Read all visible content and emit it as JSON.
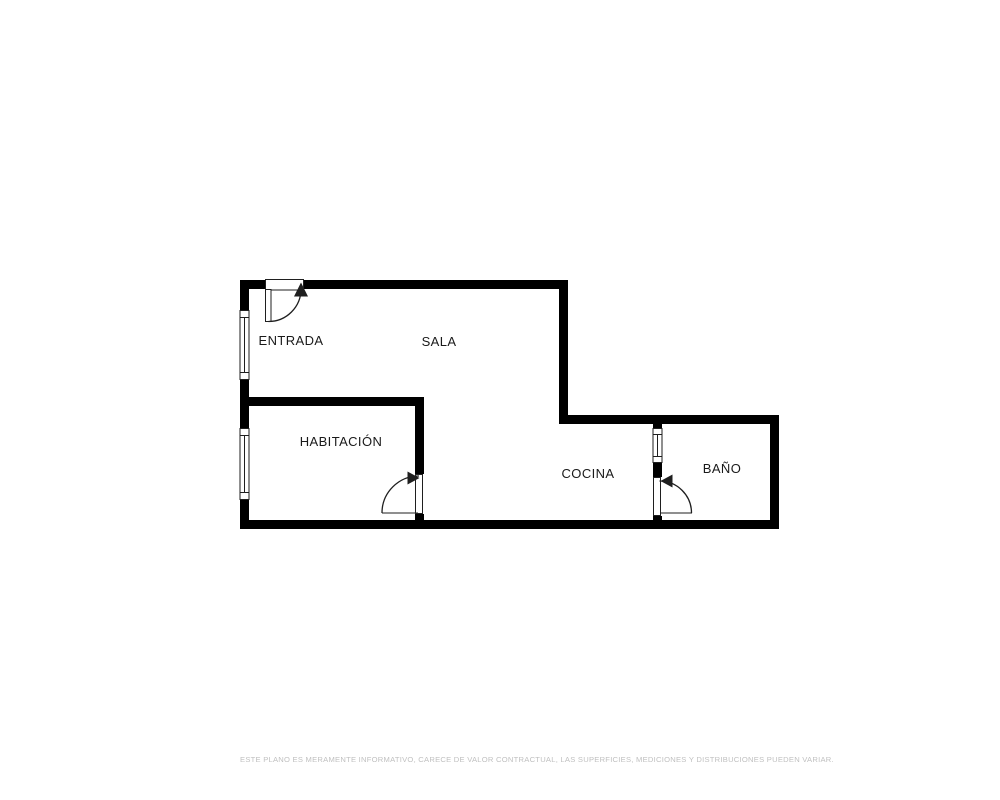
{
  "plan": {
    "colors": {
      "background": "#ffffff",
      "wall": "#000000",
      "line": "#1f1f1f",
      "label": "#1a1a1a",
      "window_fill": "#ffffff",
      "disclaimer": "#c0c0c0"
    },
    "rooms": [
      {
        "label": "ENTRADA"
      },
      {
        "label": "SALA"
      },
      {
        "label": "HABITACIÓN"
      },
      {
        "label": "COCINA"
      },
      {
        "label": "BAÑO"
      }
    ]
  },
  "footer": {
    "disclaimer": "ESTE PLANO ES MERAMENTE INFORMATIVO, CARECE DE VALOR CONTRACTUAL, LAS SUPERFICIES, MEDICIONES Y DISTRIBUCIONES PUEDEN VARIAR."
  }
}
